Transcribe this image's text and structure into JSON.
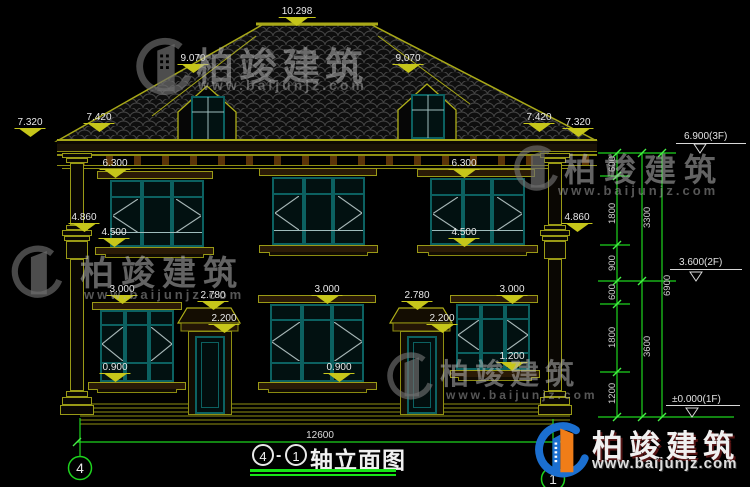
{
  "watermark": {
    "brand": "柏竣建筑",
    "url": "www.baijunjz.com"
  },
  "logo": {
    "brand": "柏竣建筑",
    "url": "www.baijunjz.com"
  },
  "marks": {
    "ridge": "10.298",
    "slope": "9.070",
    "eave_outer": "7.320",
    "eave_inner": "7.420",
    "f2_head": "6.300",
    "pilaster_cap": "4.860",
    "f2_sill": "4.500",
    "f1_head": "3.000",
    "porch": "2.780",
    "door_head": "2.200",
    "f1_sill": "0.900",
    "f1_sill_right": "1.200"
  },
  "levels": {
    "f3": "6.900(3F)",
    "f2": "3.600(2F)",
    "f1": "±0.000(1F)"
  },
  "vdims": {
    "seg600_top": "600",
    "seg1800_top": "1800",
    "seg900": "900",
    "seg600_mid": "600",
    "seg1800_bot": "1800",
    "seg1200": "1200",
    "total3300": "3300",
    "total3600": "3600",
    "total6900": "6900"
  },
  "hdims": {
    "overall_width": "12600"
  },
  "axes": {
    "left": "4",
    "right": "1"
  },
  "title": {
    "axis_a": "4",
    "axis_b": "1",
    "dash": "-",
    "label": "轴立面图"
  }
}
